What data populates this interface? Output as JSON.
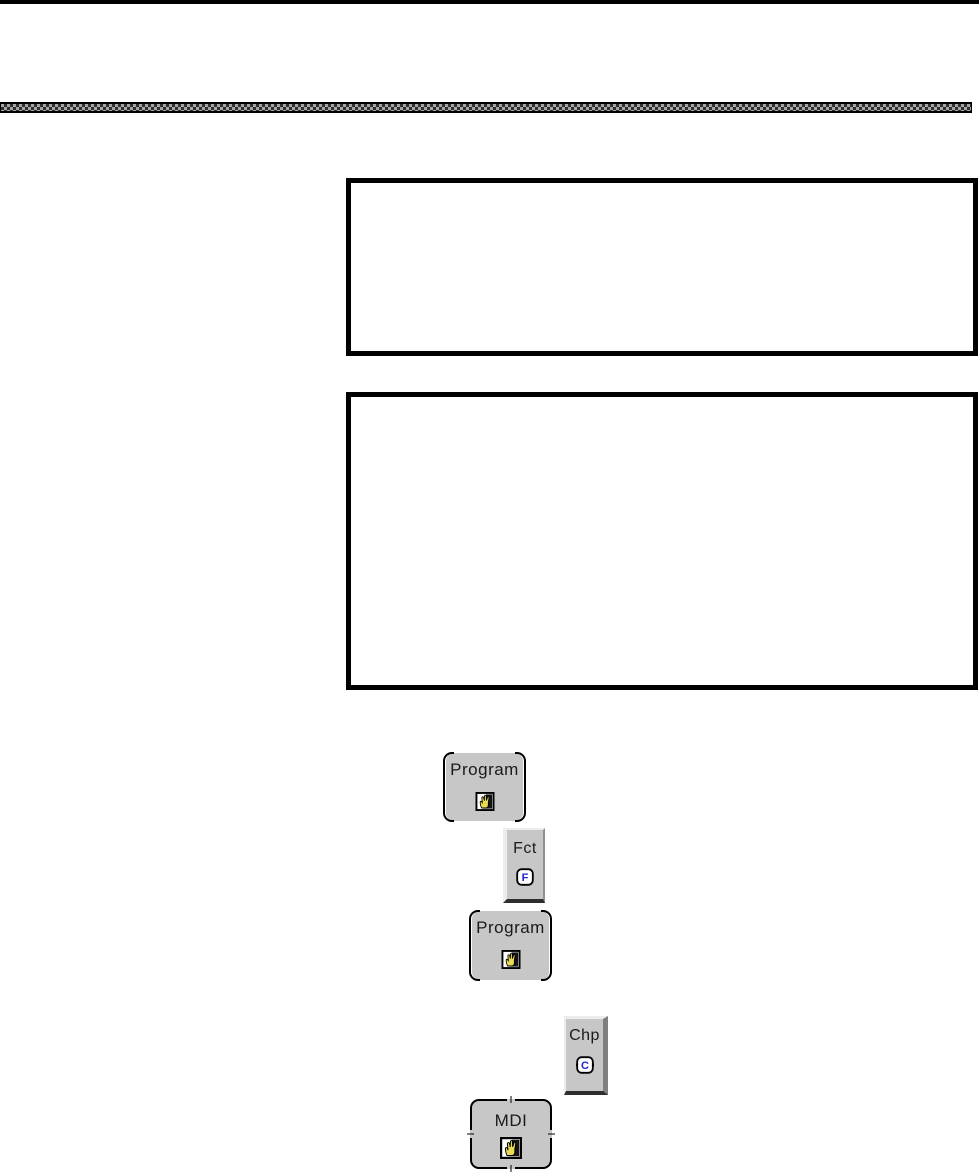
{
  "page": {
    "background": "#ffffff",
    "top_rule_color": "#000000",
    "divider_dark_color": "#303030",
    "divider_light_color": "#a6a6a6"
  },
  "keys": {
    "program_top": {
      "label": "Program",
      "icon": "hand-icon"
    },
    "fct": {
      "label": "Fct",
      "icon": "letter-f-icon",
      "icon_letter": "F"
    },
    "program_mid": {
      "label": "Program",
      "icon": "hand-icon"
    },
    "chp": {
      "label": "Chp",
      "icon": "letter-c-icon",
      "icon_letter": "C"
    },
    "mdi": {
      "label": "MDI",
      "icon": "hand-icon"
    }
  },
  "colors": {
    "key_background": "#c7c7c7",
    "key_text": "#1a1a1a",
    "hand_yellow": "#e8dc55",
    "icon_letter_blue": "#2424d0",
    "icon_frame_black": "#000000",
    "icon_backdrop_black": "#141414"
  }
}
